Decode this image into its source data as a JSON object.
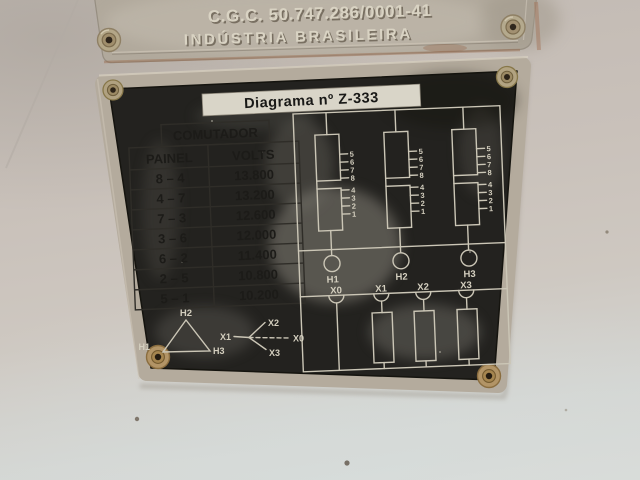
{
  "top_plate": {
    "cgc_line": "C.G.C. 50.747.286/0001-41",
    "origin_line": "INDÚSTRIA BRASILEIRA"
  },
  "diagram_plate": {
    "strip_title": "Diagrama nº Z-333",
    "comutador_table": {
      "title": "COMUTADOR",
      "columns": [
        "PAINEL",
        "VOLTS"
      ],
      "rows": [
        {
          "painel": "8 – 4",
          "volts": "13.800"
        },
        {
          "painel": "4 – 7",
          "volts": "13.200"
        },
        {
          "painel": "7 – 3",
          "volts": "12.600"
        },
        {
          "painel": "3 – 6",
          "volts": "12.000"
        },
        {
          "painel": "6 – 2",
          "volts": "11.400"
        },
        {
          "painel": "2 – 5",
          "volts": "10.800"
        },
        {
          "painel": "5 – 1",
          "volts": "10.200"
        }
      ]
    },
    "schematic": {
      "tap_numbers": [
        "5",
        "6",
        "7",
        "8",
        "4",
        "3",
        "2",
        "1"
      ],
      "hv_bushings": [
        "H1",
        "H2",
        "H3"
      ],
      "lv_bushings": [
        "X0",
        "X1",
        "X2",
        "X3"
      ],
      "delta": {
        "top": "H2",
        "bottom_left": "H1",
        "bottom_right": "H3"
      },
      "wye": {
        "line": "X1",
        "upper": "X2",
        "lower": "X3",
        "neutral": "X0"
      }
    },
    "colors": {
      "frame": "#b4ab9d",
      "face": "#23221f",
      "line_art": "#cbc6b6",
      "label_bg": "#d8d4c7",
      "table_text": "#1c1b18"
    }
  }
}
